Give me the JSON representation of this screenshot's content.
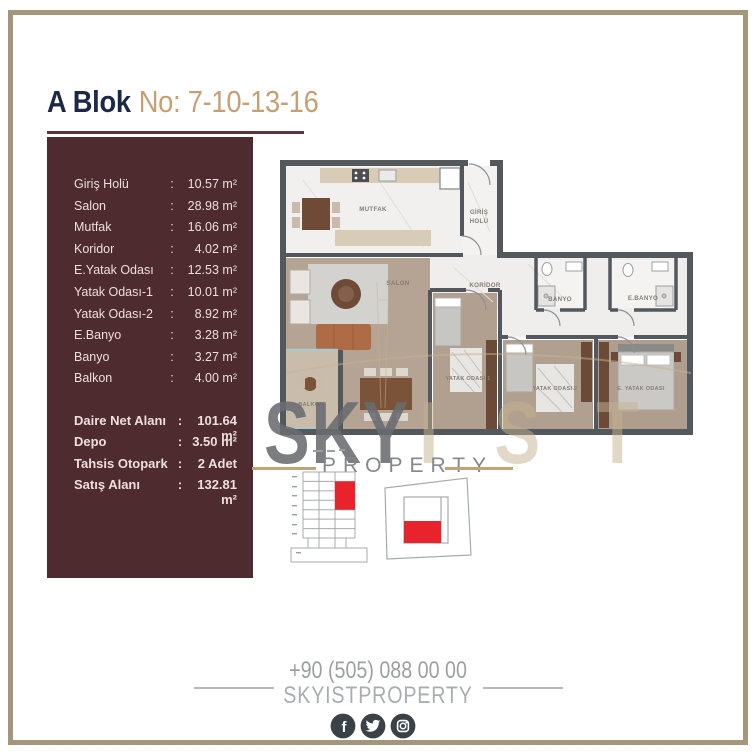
{
  "title": {
    "block": "A Blok",
    "no": "No: 7-10-13-16"
  },
  "ui": {
    "colon": ":"
  },
  "sidebar": {
    "rooms": [
      {
        "label": "Giriş Holü",
        "value": "10.57 m²"
      },
      {
        "label": "Salon",
        "value": "28.98 m²"
      },
      {
        "label": "Mutfak",
        "value": "16.06 m²"
      },
      {
        "label": "Koridor",
        "value": "4.02 m²"
      },
      {
        "label": "E.Yatak Odası",
        "value": "12.53 m²"
      },
      {
        "label": "Yatak Odası-1",
        "value": "10.01 m²"
      },
      {
        "label": "Yatak Odası-2",
        "value": "8.92 m²"
      },
      {
        "label": "E.Banyo",
        "value": "3.28 m²"
      },
      {
        "label": "Banyo",
        "value": "3.27 m²"
      },
      {
        "label": "Balkon",
        "value": "4.00 m²"
      }
    ],
    "summary": [
      {
        "label": "Daire Net Alanı",
        "value": "101.64 m²"
      },
      {
        "label": "Depo",
        "value": "3.50 m²"
      },
      {
        "label": "Tahsis Otopark",
        "value": "2 Adet"
      },
      {
        "label": "Satış Alanı",
        "value": "132.81 m²"
      }
    ]
  },
  "plan": {
    "labels": {
      "mutfak": "MUTFAK",
      "giris_line1": "GİRİŞ",
      "giris_line2": "HOLÜ",
      "salon": "SALON",
      "koridor": "KORİDOR",
      "banyo": "BANYO",
      "ebanyo": "E.BANYO",
      "yatak1": "YATAK ODASI 1",
      "yatak2": "YATAK ODASI 2",
      "eyatak": "E. YATAK ODASI",
      "balkon": "BALKON"
    }
  },
  "watermark": {
    "sky": "SKY",
    "ist": "IST",
    "property": "PROPERTY"
  },
  "footer": {
    "phone": "+90 (505) 088 00 00",
    "handle": "SKYISTPROPERTY",
    "icons": [
      "facebook-icon",
      "twitter-icon",
      "instagram-icon"
    ]
  },
  "colors": {
    "maroon": "#4e2b2e",
    "navy": "#1b2846",
    "gold": "#c79f74",
    "frame_tan": "#a3967b",
    "watermark_gray": "#6b6d71",
    "watermark_tan": "#c4b190",
    "highlight_red": "#e8232b",
    "wall_gray": "#53585c"
  }
}
